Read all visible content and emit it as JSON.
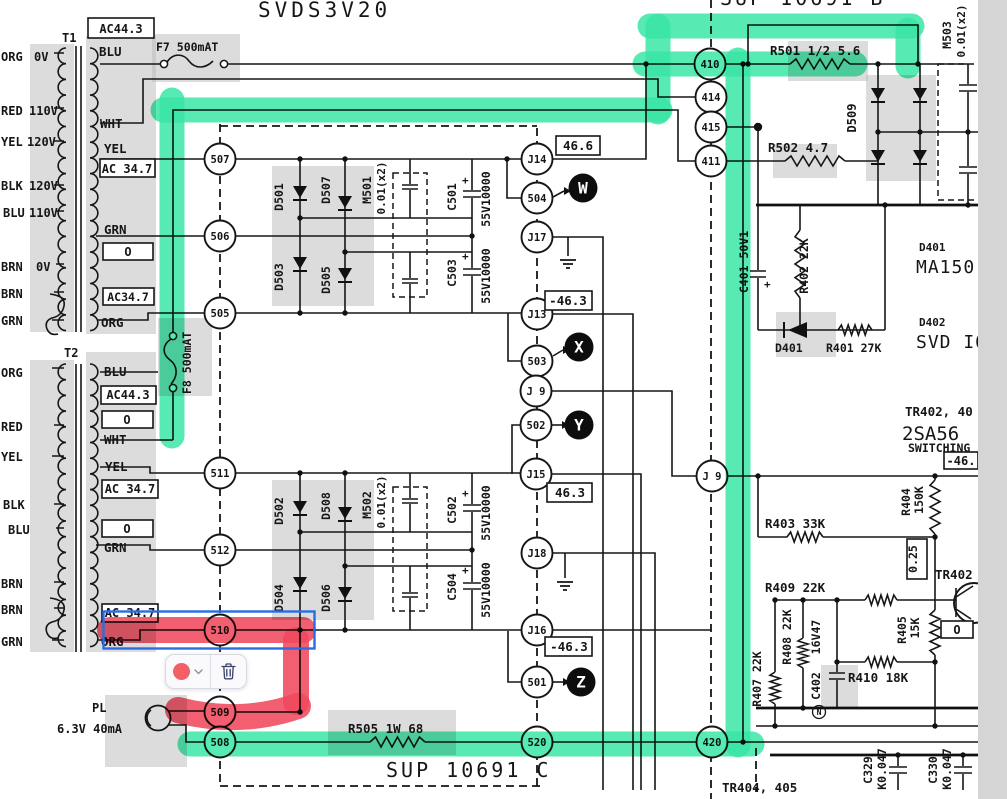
{
  "annotation": {
    "colors": {
      "highlight_green": "#3ae6a6",
      "highlight_red": "#f0495c",
      "selection_blue": "#2b6ce4",
      "swatch_red": "#f45f66"
    },
    "toolbar": {
      "swatch_icon": "color-swatch",
      "chevron_icon": "chevron-down",
      "delete_icon": "trash"
    }
  },
  "schematic": {
    "titles": {
      "main": "SVDS3V20",
      "module_top_right": "SUP 10691 B",
      "module_bottom": "SUP 10691 C"
    },
    "connectors": {
      "n507": "507",
      "n506": "506",
      "n505": "505",
      "n511": "511",
      "n512": "512",
      "n510": "510",
      "n509": "509",
      "n508": "508",
      "n504": "504",
      "n503": "503",
      "n502": "502",
      "n501": "501",
      "n520": "520",
      "n410": "410",
      "n414": "414",
      "n415": "415",
      "n411": "411",
      "n420": "420",
      "j14": "J14",
      "j17": "J17",
      "j13": "J13",
      "j9l": "J 9",
      "j15": "J15",
      "j18": "J18",
      "j16": "J16",
      "j9r": "J 9"
    },
    "points": {
      "w": "W",
      "x": "X",
      "y": "Y",
      "z": "Z"
    },
    "boxed": {
      "v466": "46.6",
      "vm463a": "-46.3",
      "v463": "46.3",
      "vm463b": "-46.3",
      "vm46": "-46.",
      "v025": "0.25",
      "vo3": "O"
    },
    "labels": {
      "t1": "T1",
      "t2": "T2",
      "ac443_t1": "AC44.3",
      "blu_t1": "BLU",
      "wht_t1": "WHT",
      "yel_t1r": "YEL",
      "ac347_t1": "AC 34.7",
      "grn_t1r": "GRN",
      "o_t1": "O",
      "ac347b_t1": "AC34.7",
      "org_t1r": "ORG",
      "org0v": "ORG",
      "v0a": "0V",
      "red": "RED",
      "v110a": "110V",
      "yel": "YEL",
      "v120a": "120V",
      "blk": "BLK",
      "v120b": "120V",
      "blu": "BLU",
      "v110b": "110V",
      "brn1": "BRN",
      "v0b": "0V",
      "brn2": "BRN",
      "grn": "GRN",
      "f7": "F7 500mAT",
      "f8": "F8 500mAT",
      "org2": "ORG",
      "red2": "RED",
      "yel2": "YEL",
      "blk2": "BLK",
      "blu2": "BLU",
      "brn3": "BRN",
      "brn4": "BRN",
      "grn2": "GRN",
      "blu_t2": "BLU",
      "ac443_t2": "AC44.3",
      "o1_t2": "O",
      "wht_t2": "WHT",
      "yel_t2": "YEL",
      "ac347_t2": "AC 34.7",
      "o2_t2": "O",
      "grn_t2": "GRN",
      "ac347b_t2": "AC 34.7",
      "org_t2": "ORG",
      "d501": "D501",
      "d507": "D507",
      "d503": "D503",
      "d505": "D505",
      "m501": "M501",
      "m501v": "0.01(x2)",
      "c501": "C501",
      "c501p": "+",
      "v55a": "55V10000",
      "c503": "C503",
      "c503p": "+",
      "v55b": "55V10000",
      "d502": "D502",
      "d508": "D508",
      "d504": "D504",
      "d506": "D506",
      "m502": "M502",
      "m502v": "0.01(x2)",
      "c502": "C502",
      "c502p": "+",
      "v55c": "55V10000",
      "c504": "C504",
      "c504p": "+",
      "v55d": "55V10000",
      "r505": "R505 1W 68",
      "pl": "PL",
      "pl_v": "6.3V 40mA",
      "r501": "R501 1/2 5.6",
      "r502": "R502 4.7",
      "d509": "D509",
      "m503": "M503",
      "m503v": "0.01(x2)",
      "c401": "C401 50V1",
      "c401p": "+",
      "r402": "R402 22K",
      "d401s": "D401",
      "r401": "R401 27K",
      "d401t": "D401",
      "ma150": "MA150",
      "d402t": "D402",
      "svd": "SVD I0",
      "tr402_40": "TR402, 40",
      "sa56": "2SA56",
      "switching": "SWITCHING",
      "r404": "R404",
      "r404v": "150K",
      "r403": "R403 33K",
      "tr402": "TR402",
      "r409": "R409 22K",
      "r405": "R405",
      "r405v": "15K",
      "r408": "R408 22K",
      "v16v47": "16V47",
      "c402": "C402",
      "n": "N",
      "r410": "R410 18K",
      "r407": "R407 22K",
      "c329": "C329",
      "k047a": "K0.047",
      "c330": "C330",
      "k047b": "K0.047",
      "tr404": "TR404, 405"
    }
  }
}
